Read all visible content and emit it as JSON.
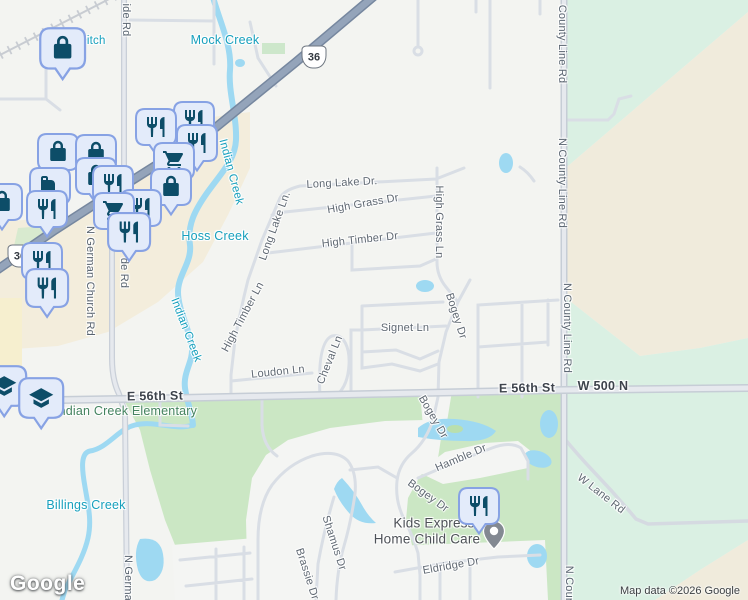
{
  "app": {
    "logo_text": "Google",
    "attribution": "Map data ©2026 Google"
  },
  "colors": {
    "background": "#f3f4f1",
    "commercial_beige": "#f3eddc",
    "field_beige": "#f0ebdc",
    "mint_green": "#daf0e3",
    "golf_green": "#cbe7c4",
    "water_blue": "#9ed9f2",
    "highway_fill": "#94a4ba",
    "road_casing": "#c6cdd6",
    "minor_road": "#d9dee5",
    "pin_fill": "#e3ebfa",
    "pin_border": "#87a2e4",
    "pin_icon": "#0d4d68",
    "water_label": "#17a0bd",
    "school_label": "#44835f",
    "street_label": "#5f6872"
  },
  "route_shields": [
    {
      "number": "36"
    },
    {
      "number": "36"
    }
  ],
  "labels": [
    {
      "text": "Ditch",
      "kind": "water",
      "x": 92,
      "y": 41,
      "rot": 0
    },
    {
      "text": "ide Rd",
      "kind": "road-vert",
      "x": 126,
      "y": 20,
      "rot": 90
    },
    {
      "text": "Mock Creek",
      "kind": "water-lg",
      "x": 225,
      "y": 40,
      "rot": 0
    },
    {
      "text": "County Line Rd",
      "kind": "road-vert",
      "x": 562,
      "y": 44,
      "rot": 90
    },
    {
      "text": "N County Line Rd",
      "kind": "road-vert",
      "x": 562,
      "y": 183,
      "rot": 90
    },
    {
      "text": "N County Line Rd",
      "kind": "road-vert",
      "x": 567,
      "y": 328,
      "rot": 90
    },
    {
      "text": "N Coun",
      "kind": "road-vert",
      "x": 569,
      "y": 585,
      "rot": 90
    },
    {
      "text": "Long Lake Dr.",
      "kind": "street",
      "x": 342,
      "y": 183,
      "rot": -3
    },
    {
      "text": "High Grass Dr",
      "kind": "street",
      "x": 363,
      "y": 204,
      "rot": -10
    },
    {
      "text": "Indian Creek",
      "kind": "water",
      "x": 231,
      "y": 172,
      "rot": 75
    },
    {
      "text": "Indian Creek",
      "kind": "water",
      "x": 186,
      "y": 330,
      "rot": 69
    },
    {
      "text": "Long Lake Ln.",
      "kind": "street",
      "x": 275,
      "y": 226,
      "rot": -70
    },
    {
      "text": "High Timber Dr",
      "kind": "street",
      "x": 360,
      "y": 240,
      "rot": -6
    },
    {
      "text": "Hoss Creek",
      "kind": "water-lg",
      "x": 215,
      "y": 236,
      "rot": 0
    },
    {
      "text": "N German Church Rd",
      "kind": "road-vert",
      "x": 90,
      "y": 281,
      "rot": 90
    },
    {
      "text": "de Rd",
      "kind": "road-vert",
      "x": 124,
      "y": 273,
      "rot": 90
    },
    {
      "text": "High Timber Ln",
      "kind": "street",
      "x": 243,
      "y": 317,
      "rot": -62
    },
    {
      "text": "High Grass Ln",
      "kind": "street",
      "x": 439,
      "y": 222,
      "rot": 90
    },
    {
      "text": "Bogey Dr",
      "kind": "street",
      "x": 456,
      "y": 316,
      "rot": 72
    },
    {
      "text": "Signet Ln",
      "kind": "street",
      "x": 405,
      "y": 328,
      "rot": 0
    },
    {
      "text": "Cheval Ln",
      "kind": "street",
      "x": 330,
      "y": 360,
      "rot": -68
    },
    {
      "text": "Loudon Ln",
      "kind": "street",
      "x": 278,
      "y": 372,
      "rot": -6
    },
    {
      "text": "E 56th St",
      "kind": "road-major",
      "x": 155,
      "y": 396,
      "rot": -1
    },
    {
      "text": "E 56th St",
      "kind": "road-major",
      "x": 527,
      "y": 388,
      "rot": -1
    },
    {
      "text": "W 500 N",
      "kind": "road-major",
      "x": 603,
      "y": 386,
      "rot": 0
    },
    {
      "text": "Indian Creek Elementary",
      "kind": "school",
      "x": 126,
      "y": 411,
      "rot": 0
    },
    {
      "text": "Bogey Dr",
      "kind": "street",
      "x": 433,
      "y": 417,
      "rot": 60
    },
    {
      "text": "Hamble Dr",
      "kind": "street",
      "x": 461,
      "y": 458,
      "rot": -23
    },
    {
      "text": "Bogey Dr",
      "kind": "street",
      "x": 428,
      "y": 496,
      "rot": 36
    },
    {
      "text": "W Lane Rd",
      "kind": "street",
      "x": 601,
      "y": 494,
      "rot": 38
    },
    {
      "text": "Kids Express",
      "kind": "poi",
      "x": 434,
      "y": 523,
      "rot": 0
    },
    {
      "text": "Home Child Care",
      "kind": "poi",
      "x": 427,
      "y": 539,
      "rot": 0
    },
    {
      "text": "Shamus Dr",
      "kind": "street",
      "x": 334,
      "y": 543,
      "rot": 72
    },
    {
      "text": "Brassie Dr",
      "kind": "street",
      "x": 307,
      "y": 574,
      "rot": 72
    },
    {
      "text": "Eldridge Dr",
      "kind": "street",
      "x": 451,
      "y": 566,
      "rot": -10
    },
    {
      "text": "Billings Creek",
      "kind": "water-lg",
      "x": 86,
      "y": 505,
      "rot": 0
    },
    {
      "text": "N Germa",
      "kind": "road-vert",
      "x": 128,
      "y": 578,
      "rot": 90
    }
  ],
  "markers": [
    {
      "icon": "shopping-bag",
      "x": 63,
      "y": 48,
      "s": 1.12
    },
    {
      "icon": "restaurant",
      "x": 194,
      "y": 120,
      "s": 1
    },
    {
      "icon": "restaurant",
      "x": 156,
      "y": 127,
      "s": 1
    },
    {
      "icon": "restaurant",
      "x": 197,
      "y": 143,
      "s": 1
    },
    {
      "icon": "shopping-bag",
      "x": 58,
      "y": 152,
      "s": 1
    },
    {
      "icon": "shopping-bag",
      "x": 96,
      "y": 153,
      "s": 1
    },
    {
      "icon": "shopping-cart",
      "x": 174,
      "y": 161,
      "s": 1
    },
    {
      "icon": "shopping-bag",
      "x": 96,
      "y": 176,
      "s": 1
    },
    {
      "icon": "coffee-mug",
      "x": 50,
      "y": 186,
      "s": 1
    },
    {
      "icon": "restaurant",
      "x": 113,
      "y": 184,
      "s": 1
    },
    {
      "icon": "shopping-bag",
      "x": 171,
      "y": 187,
      "s": 1
    },
    {
      "icon": "shopping-bag",
      "x": 2,
      "y": 202,
      "s": 1
    },
    {
      "icon": "restaurant",
      "x": 141,
      "y": 208,
      "s": 1
    },
    {
      "icon": "restaurant",
      "x": 47,
      "y": 209,
      "s": 1
    },
    {
      "icon": "shopping-cart",
      "x": 114,
      "y": 211,
      "s": 1
    },
    {
      "icon": "restaurant",
      "x": 129,
      "y": 232,
      "s": 1.05
    },
    {
      "icon": "restaurant",
      "x": 42,
      "y": 261,
      "s": 1
    },
    {
      "icon": "restaurant",
      "x": 47,
      "y": 288,
      "s": 1.05
    },
    {
      "icon": "school",
      "x": 4,
      "y": 386,
      "s": 1.1
    },
    {
      "icon": "school",
      "x": 41,
      "y": 398,
      "s": 1.1
    },
    {
      "icon": "location-pin",
      "x": 494,
      "y": 536,
      "s": 1
    },
    {
      "icon": "restaurant",
      "x": 479,
      "y": 506,
      "s": 1
    }
  ]
}
